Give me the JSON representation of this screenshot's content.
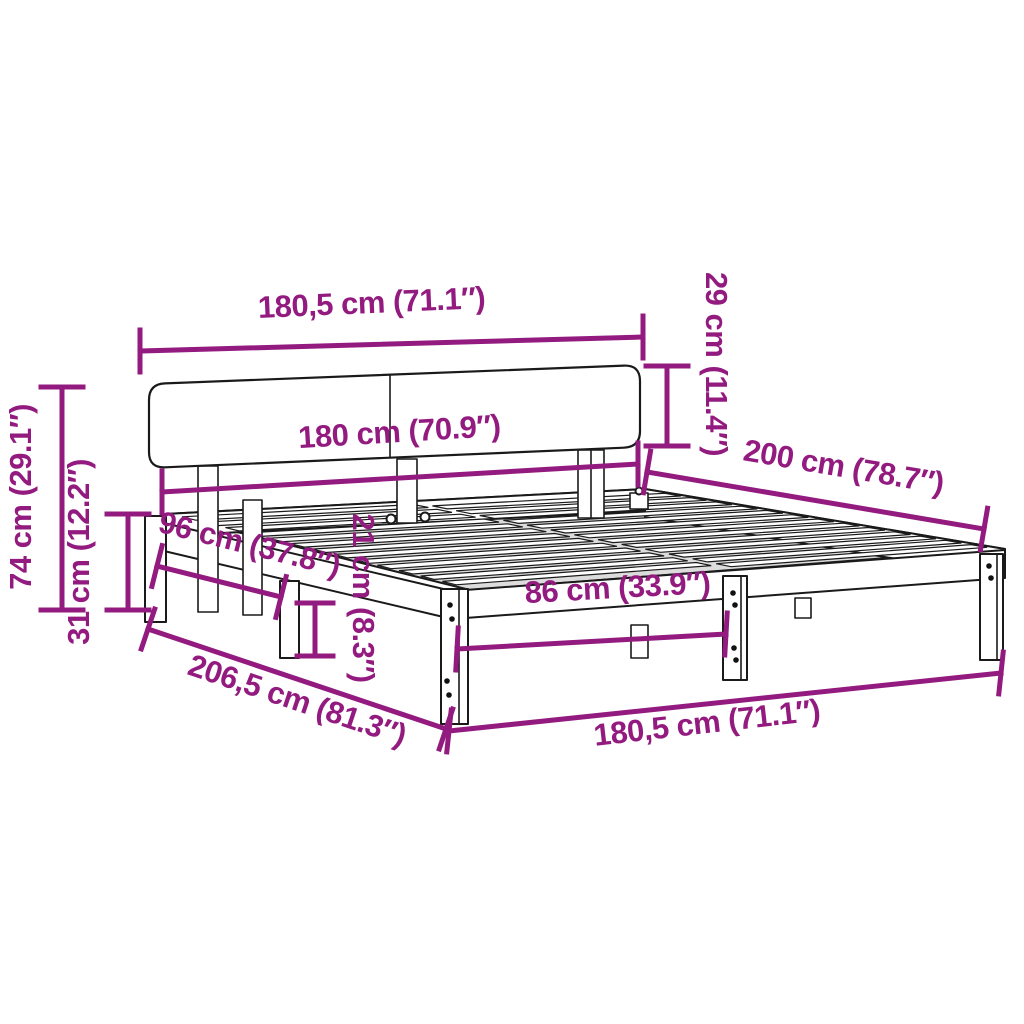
{
  "diagram": {
    "type": "furniture-dimension-diagram",
    "subject": "bed frame with headboard and slatted base",
    "style": {
      "dimension_color": "#931b80",
      "outline_color": "#1a1a1a",
      "background": "#ffffff"
    },
    "dimensions": [
      {
        "id": "overall-width-top",
        "label": "180,5 cm (71.1″)",
        "placement": "top",
        "orientation": "horizontal"
      },
      {
        "id": "headboard-height",
        "label": "29 cm (11.4″)",
        "placement": "upper-right",
        "orientation": "vertical"
      },
      {
        "id": "headboard-inner-width",
        "label": "180 cm (70.9″)",
        "placement": "below-headboard",
        "orientation": "horizontal"
      },
      {
        "id": "bed-length",
        "label": "200 cm (78.7″)",
        "placement": "right-side",
        "orientation": "diagonal"
      },
      {
        "id": "overall-height",
        "label": "74 cm (29.1″)",
        "placement": "left-outer",
        "orientation": "vertical"
      },
      {
        "id": "frame-height",
        "label": "31 cm (12.2″)",
        "placement": "left-inner",
        "orientation": "vertical"
      },
      {
        "id": "side-leg-spacing",
        "label": "96 cm (37.8″)",
        "placement": "left-rail",
        "orientation": "diagonal"
      },
      {
        "id": "rail-height",
        "label": "21 cm (8.3″)",
        "placement": "center-left",
        "orientation": "vertical"
      },
      {
        "id": "front-leg-spacing",
        "label": "86 cm (33.9″)",
        "placement": "front-center",
        "orientation": "horizontal"
      },
      {
        "id": "overall-length",
        "label": "206,5 cm (81.3″)",
        "placement": "bottom-left",
        "orientation": "diagonal"
      },
      {
        "id": "overall-width-bottom",
        "label": "180,5 cm (71.1″)",
        "placement": "bottom-right",
        "orientation": "horizontal"
      }
    ]
  }
}
